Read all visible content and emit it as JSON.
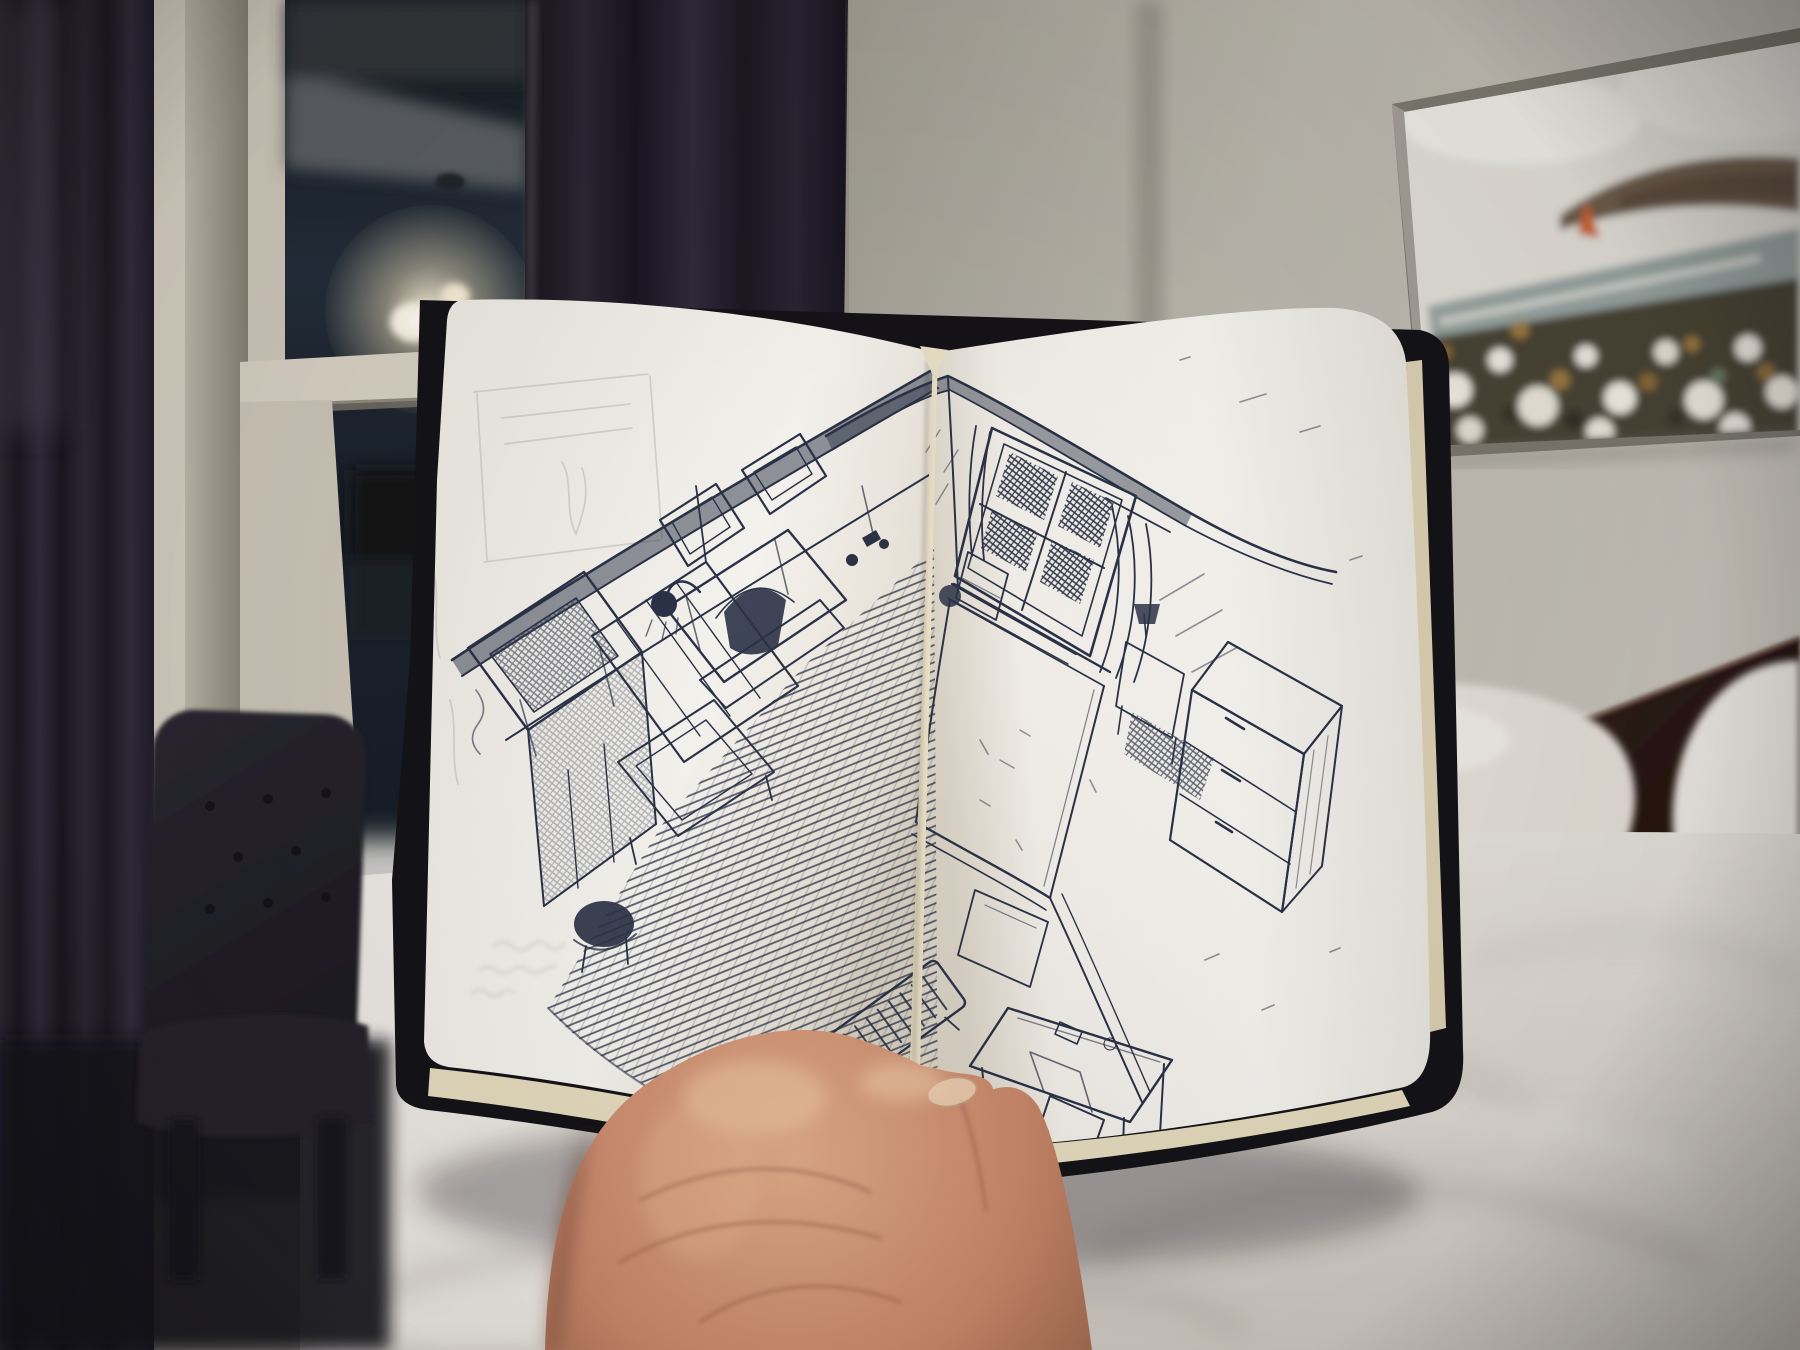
{
  "scene": {
    "title": "Hand holding an open sketchbook in a dim bedroom",
    "description": "A left hand holds up an open sketchbook showing a two-page blue-black ballpoint pen sketch of a bedroom interior drawn from a high corner viewpoint. Behind it: a night-dark sash window flanked by dark plum curtains with the glowing reflection of a pendant chandelier, a charcoal tufted chair, a bed with rumpled white duvet and pillows against a dark wood headboard, and a blurry coastal painting of a flower field hanging on a warm grey wall.",
    "time_of_day": "night",
    "focus": "sketchbook and hand in focus; room background softly blurred"
  },
  "palette": {
    "curtain_dark": "#211d28",
    "curtain_mid": "#2e2936",
    "curtain_highlight": "#4b4452",
    "window_frame": "#d6cfc1",
    "window_frame_shadow": "#9a9285",
    "glass_dark": "#10141b",
    "glass_reflection_blue": "#3e4c5a",
    "chandelier_glow": "#fff3d6",
    "wall_left": "#a8a49a",
    "wall_right": "#c6c2b9",
    "wall_corner_shadow": "#8f8b81",
    "painting_sky": "#e4e1d9",
    "painting_sea": "#9aa5a3",
    "painting_headland": "#6f5d4b",
    "painting_sail": "#cc6329",
    "painting_flower_white": "#f1ede3",
    "painting_flower_gold": "#9c7b42",
    "painting_foliage": "#4a4434",
    "painting_frame": "#7e7b70",
    "headboard_wood": "#33201a",
    "pillow_white": "#ece8e1",
    "duvet_white": "#e3dfd8",
    "duvet_shadow": "#b3aea6",
    "chair_fabric": "#232028",
    "page_white": "#f6f4ef",
    "page_shadow": "#d8d2c6",
    "page_edge_cream": "#e6dcbf",
    "cover_black": "#141317",
    "ink": "#2b3247",
    "pencil_ghost": "#bdb7ac",
    "skin_light": "#e4b494",
    "skin_mid": "#c68d6d",
    "skin_shadow": "#8d573f",
    "nail": "#e8c7a9"
  },
  "background": {
    "window": {
      "label": "sash window, dark at night",
      "reflections": [
        "ceiling of the room",
        "pendant chandelier with glowing bulbs",
        "dark rectangle of furniture"
      ]
    },
    "curtains": {
      "label": "dark plum blackout curtains",
      "panels": 2
    },
    "chair": {
      "label": "charcoal button-tufted chair"
    },
    "wall_art": {
      "label": "coastal landscape painting, out of focus",
      "elements": [
        "pale overcast sky",
        "brown headland",
        "grey-green sea",
        "small orange sail",
        "field of white and gold wildflowers"
      ]
    },
    "bed": {
      "label": "bed with rumpled white duvet and pillows",
      "headboard": "dark reddish wood"
    }
  },
  "sketchbook": {
    "label": "open notebook held vertically, two-page ballpoint sketch of a bedroom seen from above",
    "cover": "black, rounded corners",
    "page_edges": "cream",
    "ink_color_name": "blue-black ballpoint",
    "left_page": {
      "media": [
        "faint pencil underdrawing",
        "pen sketch"
      ],
      "subjects": [
        "wardrobe with mirror",
        "glass shower enclosure with shower head",
        "fireplace with arched firebox and mantel objects",
        "two picture frames on the wall",
        "dark stool",
        "densely hatched carpet",
        "slatted radiator"
      ],
      "ghost_writing": {
        "visible": true,
        "legible": false,
        "note": "mirrored handwriting showing through from the reverse side of the page"
      }
    },
    "right_page": {
      "media": [
        "pen sketch"
      ],
      "subjects": [
        "room corner",
        "window with dark cross-hatched panes and curtains",
        "bed with pillow",
        "nightstand and small lamp",
        "chest of drawers",
        "desk with chair",
        "radiator"
      ]
    }
  },
  "hand": {
    "label": "left hand holding the book open",
    "parts": [
      "palm",
      "thumb pressed over the page bottoms",
      "index finger"
    ],
    "skin_tone": "light-medium warm"
  }
}
